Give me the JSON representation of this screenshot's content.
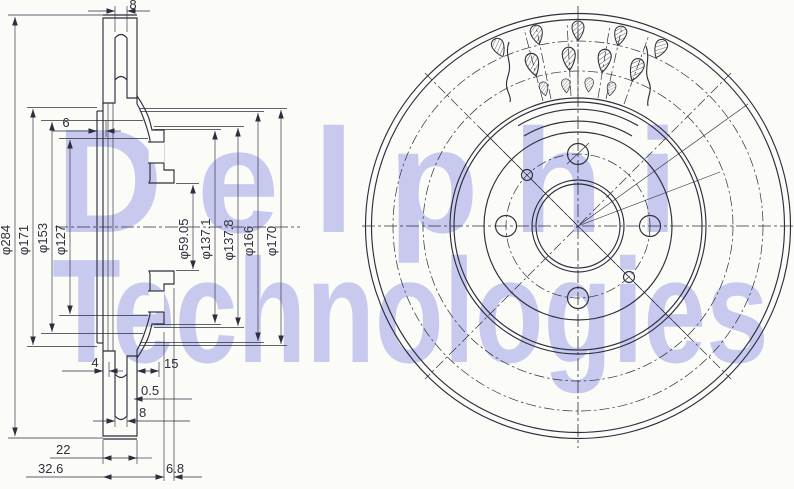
{
  "watermark": {
    "line1": "Delphi",
    "line2": "Technologies"
  },
  "colors": {
    "line": "#2e2e3e",
    "watermark": "#c7caee",
    "background": "#fbfbf7"
  },
  "section_view": {
    "dims": {
      "top8": "8",
      "left6": "6",
      "d284": "φ284",
      "d171": "φ171",
      "d153": "φ153",
      "d127": "φ127",
      "d59_05": "φ59.05",
      "d137_1": "φ137.1",
      "d137_8": "φ137.8",
      "d166": "φ166",
      "d170": "φ170",
      "b4": "4",
      "b15": "15",
      "b0_5": "0.5",
      "b8": "8",
      "b22": "22",
      "b32_6": "32.6",
      "b6_8": "6.8"
    }
  }
}
